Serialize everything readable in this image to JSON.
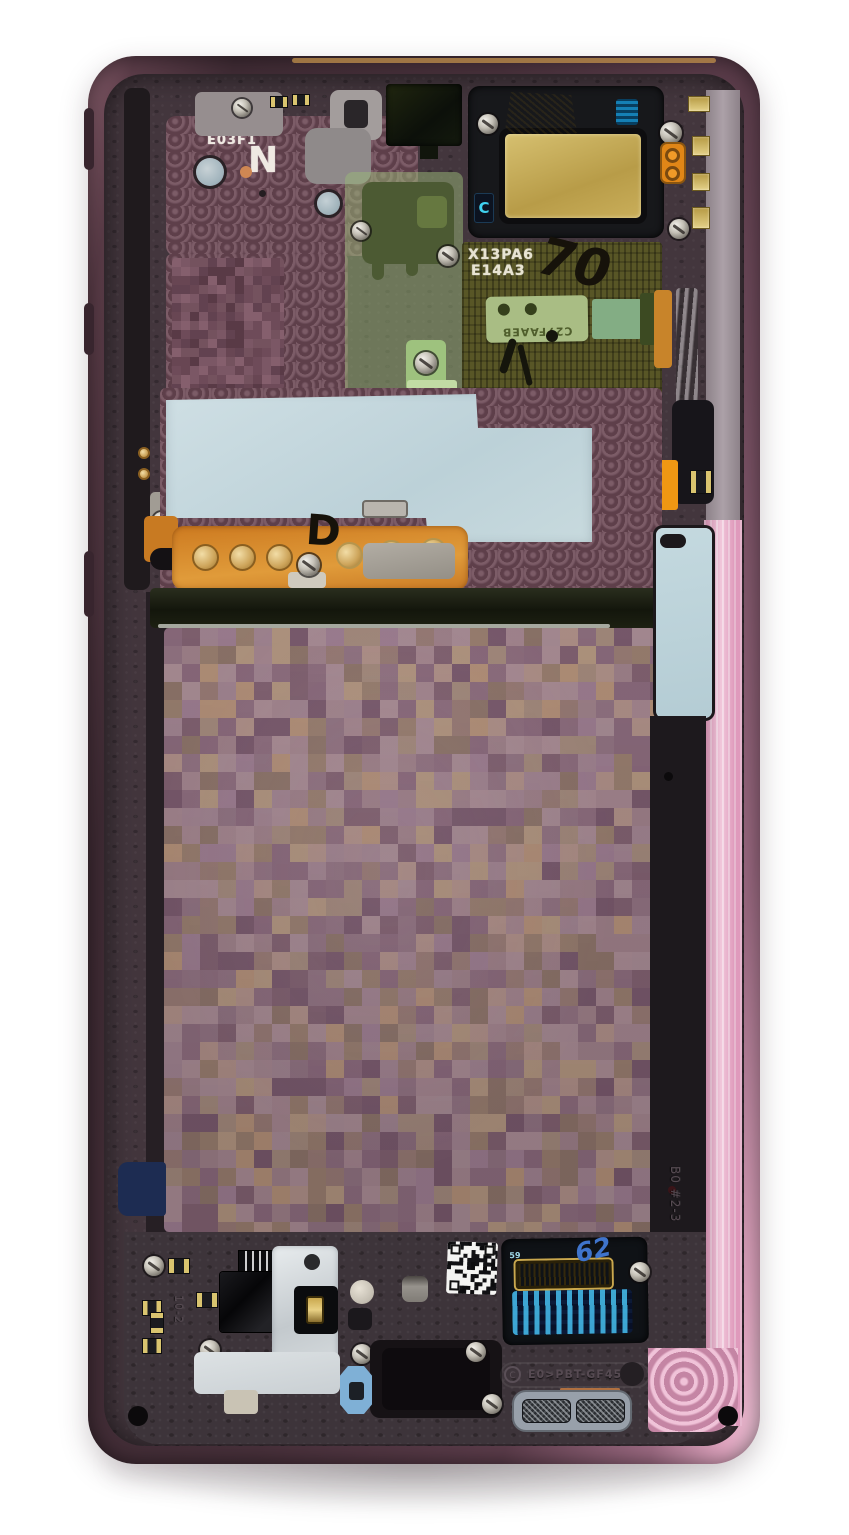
{
  "labels": {
    "etch_line1": "K13U0L",
    "etch_line2": "E03F1",
    "letter_n": "N",
    "module_line1": "X13PA6",
    "module_line2": "E14A3",
    "marker_number": "70",
    "green_sticker_code": "C27FAAEB",
    "blue_sticker_c": "C",
    "marker_d": "D",
    "orange_tag": "B0 R0.2",
    "connector_pin": "59",
    "blue_marker": "62",
    "emboss_frame_code": "B0 #2-3",
    "emboss_material_right": "PA-G550",
    "emboss_material_bottom": "E0>PBT-GF45<",
    "emboss_recycle_c": "C",
    "emboss_bottom_left": "10-2"
  },
  "colors": {
    "frame_pink": "#e5a9c4",
    "frame_dark": "#3f2b34",
    "chassis": "#43363d",
    "thermal_pad_blue": "#c5d8de",
    "speaker_gold": "#c7b269",
    "flex_orange": "#d08127",
    "label_olive": "#585626",
    "sticker_green": "#a9bd84",
    "navy_sticker": "#1d2c52",
    "gasket_blue": "#7fb0d6"
  },
  "textures": {
    "mosaics": [
      {
        "target": "battery-mosaic",
        "w": 492,
        "h": 604,
        "cell": 18,
        "seed": 7,
        "palette": [
          "#9c8088",
          "#a68c94",
          "#8e7280",
          "#a18a7a",
          "#b29176",
          "#7d5f6e",
          "#957a72",
          "#a88d94",
          "#8a6c7c",
          "#9f8490",
          "#87687a",
          "#ae9187",
          "#967e6c",
          "#8a7366",
          "#a2868e",
          "#b1977e",
          "#75576a",
          "#9b7d90"
        ]
      },
      {
        "target": "pixel-block",
        "w": 112,
        "h": 132,
        "cell": 9,
        "seed": 3,
        "palette": [
          "#6e4b59",
          "#7b5765",
          "#624250",
          "#855f6d",
          "#593a46",
          "#74525e",
          "#684653"
        ]
      },
      {
        "target": "qr-pixels",
        "w": 50,
        "h": 52,
        "cell": 4,
        "seed": 11,
        "palette": [
          "#111114",
          "#f4f4f2",
          "#111114",
          "#f4f4f2",
          "#0c0c0e",
          "#f4f4f2",
          "#f4f4f2"
        ]
      }
    ]
  }
}
